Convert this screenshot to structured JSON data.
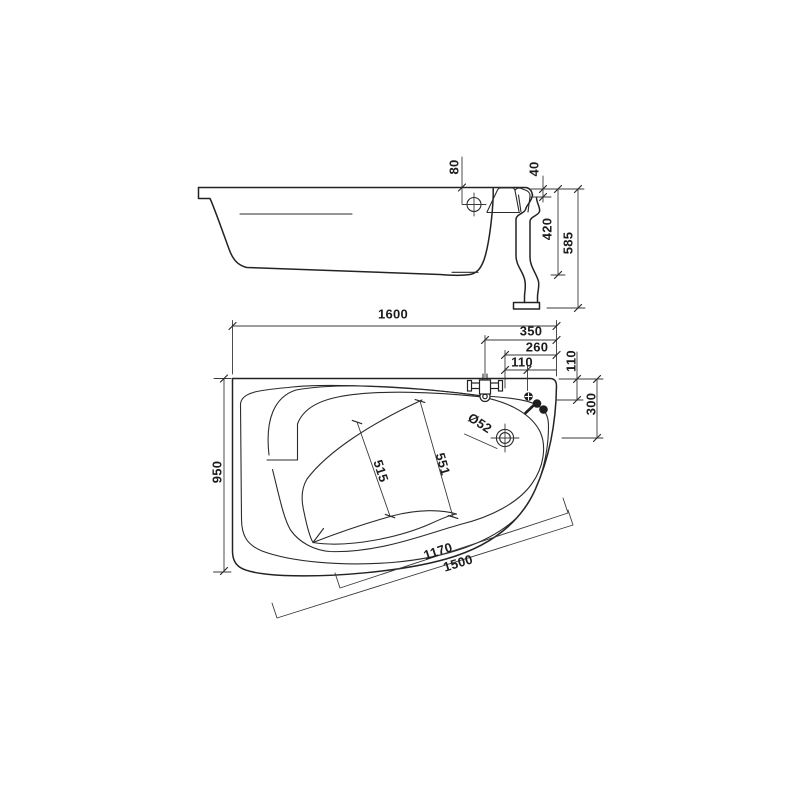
{
  "drawing": {
    "side_view": {
      "overflow_to_rim": "80",
      "rim_step": "40",
      "tub_depth": "420",
      "overall_height": "585"
    },
    "plan_view": {
      "overall_length": "1600",
      "overall_width": "950",
      "faucet_offset": "350",
      "fitting_offset_260": "260",
      "fitting_offset_110": "110",
      "edge_distance_110": "110",
      "drain_distance_300": "300",
      "drain_diameter": "Ø52",
      "inner_width_515": "515",
      "inner_width_551": "551",
      "inner_edge_length": "1170",
      "outer_edge_length": "1500"
    }
  }
}
